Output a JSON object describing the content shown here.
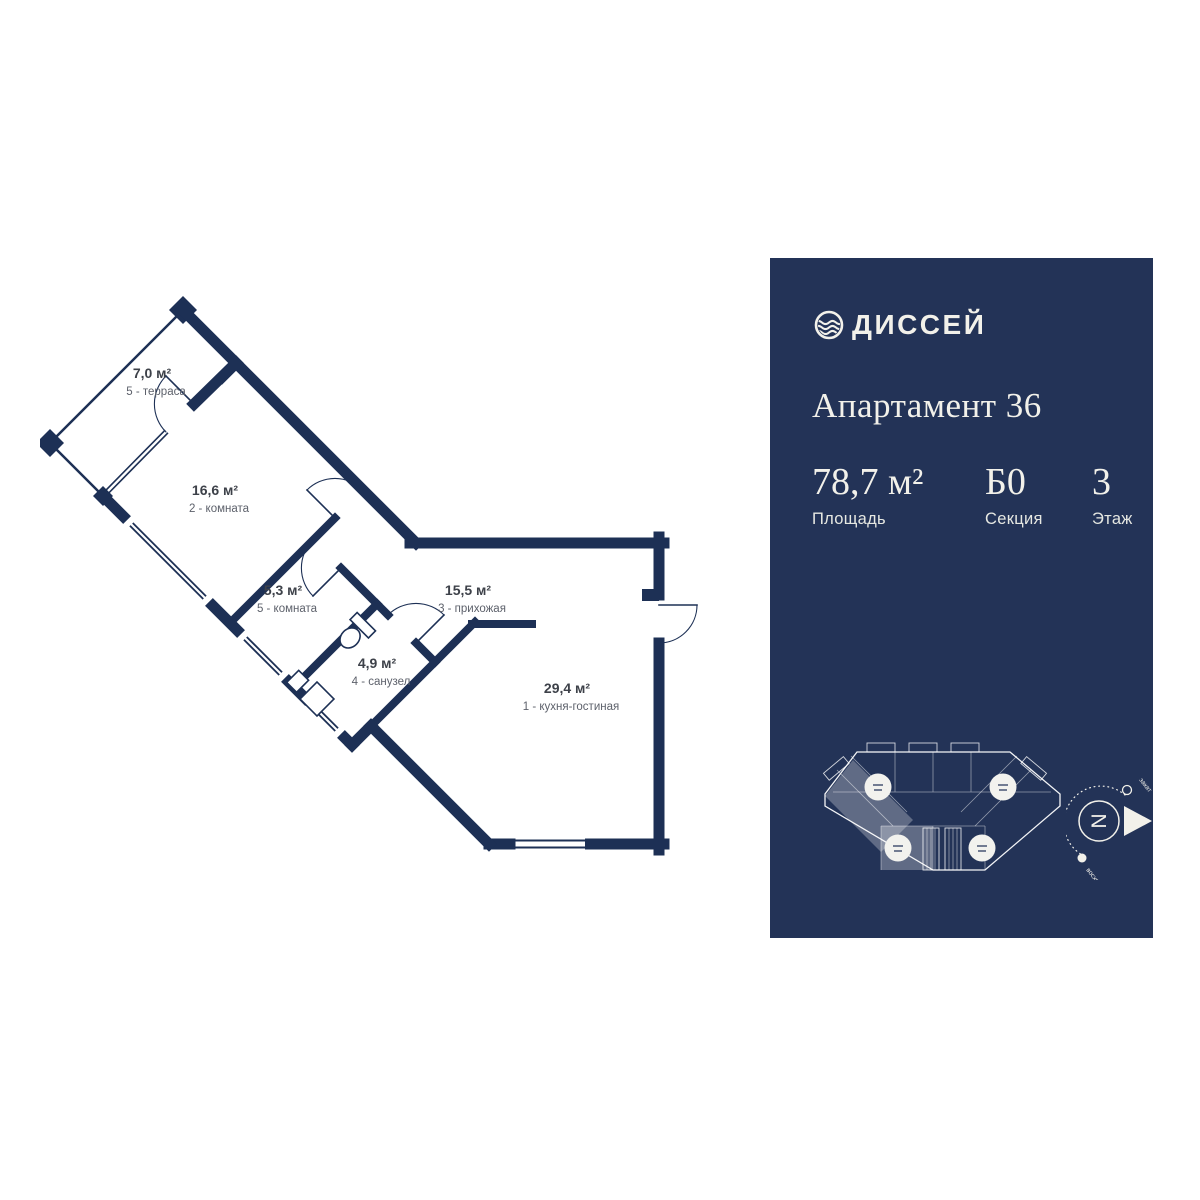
{
  "panel": {
    "logo": {
      "text": "ДИССЕЙ",
      "icon": "wave-o-icon"
    },
    "title": "Апартамент 36",
    "stats": [
      {
        "value": "78,7 м²",
        "label": "Площадь"
      },
      {
        "value": "Б0",
        "label": "Секция"
      },
      {
        "value": "3",
        "label": "Этаж"
      }
    ],
    "compass": {
      "north": "N",
      "sunset": "закат",
      "sunrise": "восход"
    },
    "colors": {
      "background": "#233357",
      "text": "#f2f1ea"
    }
  },
  "floor_plan": {
    "rooms": [
      {
        "area": "7,0 м²",
        "name": "5 - терраса"
      },
      {
        "area": "16,6 м²",
        "name": "2 - комната"
      },
      {
        "area": "5,3 м²",
        "name": "5 - комната"
      },
      {
        "area": "4,9 м²",
        "name": "4 - санузел"
      },
      {
        "area": "15,5 м²",
        "name": "3 - прихожая"
      },
      {
        "area": "29,4 м²",
        "name": "1 - кухня-гостиная"
      }
    ],
    "wall_color": "#1d3055",
    "label_color": "#3d4149"
  }
}
